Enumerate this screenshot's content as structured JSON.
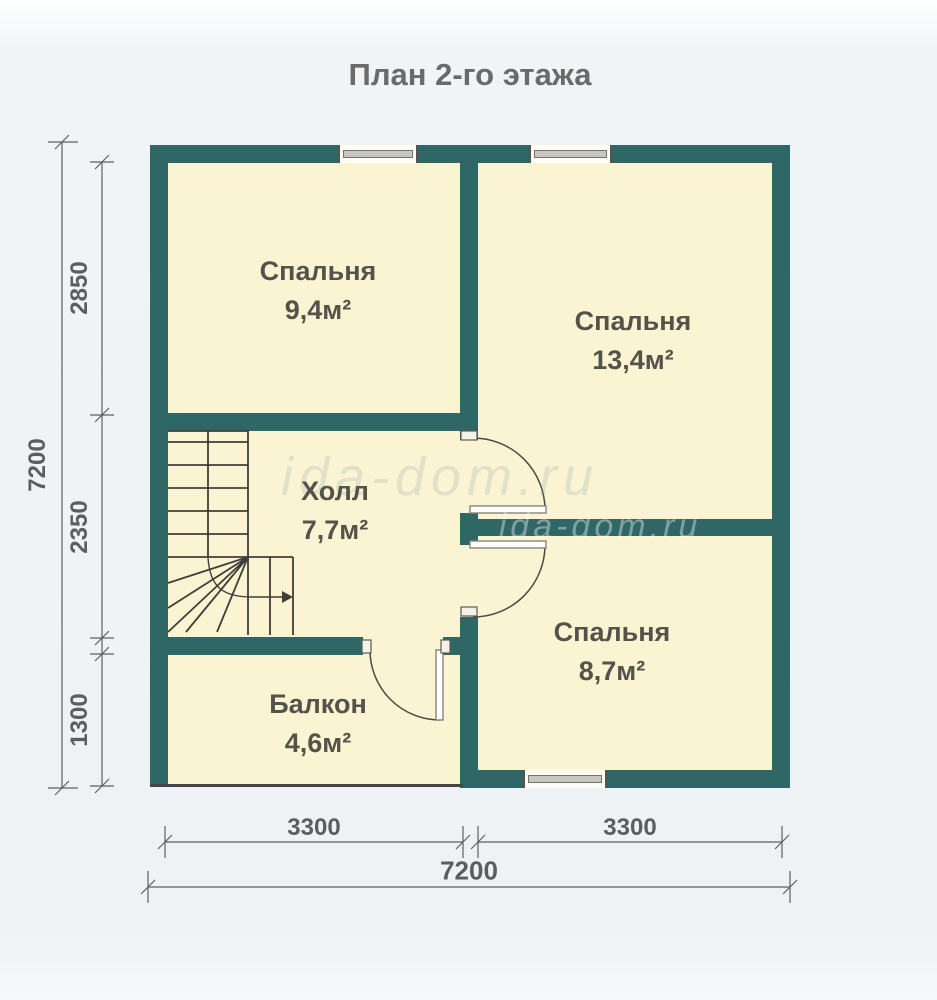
{
  "title": "План 2-го этажа",
  "watermark": "ida-dom.ru",
  "rooms": [
    {
      "name": "Спальня",
      "area": "9,4м²"
    },
    {
      "name": "Спальня",
      "area": "13,4м²"
    },
    {
      "name": "Холл",
      "area": "7,7м²"
    },
    {
      "name": "Спальня",
      "area": "8,7м²"
    },
    {
      "name": "Балкон",
      "area": "4,6м²"
    }
  ],
  "dimensions": {
    "left": {
      "total": "7200",
      "segments": [
        "2850",
        "2350",
        "1300"
      ]
    },
    "bottom": {
      "total": "7200",
      "segments": [
        "3300",
        "3300"
      ]
    }
  },
  "colors": {
    "wall": "#2f6766",
    "room_fill": "#fbf4d2",
    "dimension_text": "#5d5d5d",
    "label_text": "#54534b"
  }
}
